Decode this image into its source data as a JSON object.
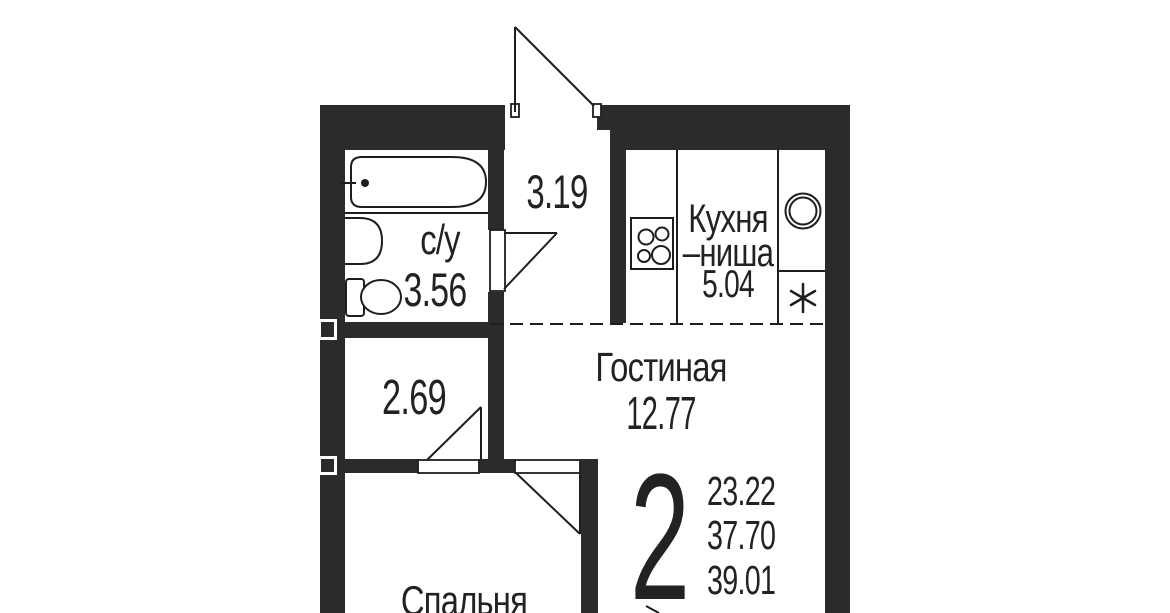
{
  "floorplan": {
    "colors": {
      "wall": "#2c2b2a",
      "line": "#1e1e1e",
      "text": "#222222",
      "background": "#ffffff"
    },
    "rooms": {
      "bathroom": {
        "label": "с/у",
        "area": "3.56"
      },
      "hallway": {
        "area": "3.19"
      },
      "kitchen_niche": {
        "label_line1": "Кухня",
        "label_line2": "–ниша",
        "area": "5.04"
      },
      "living_room": {
        "label": "Гостиная",
        "area": "12.77"
      },
      "corridor": {
        "area": "2.69"
      },
      "bedroom": {
        "label": "Спальня"
      }
    },
    "apartment": {
      "rooms_count": "2",
      "areas": [
        "23.22",
        "37.70",
        "39.01"
      ]
    }
  }
}
